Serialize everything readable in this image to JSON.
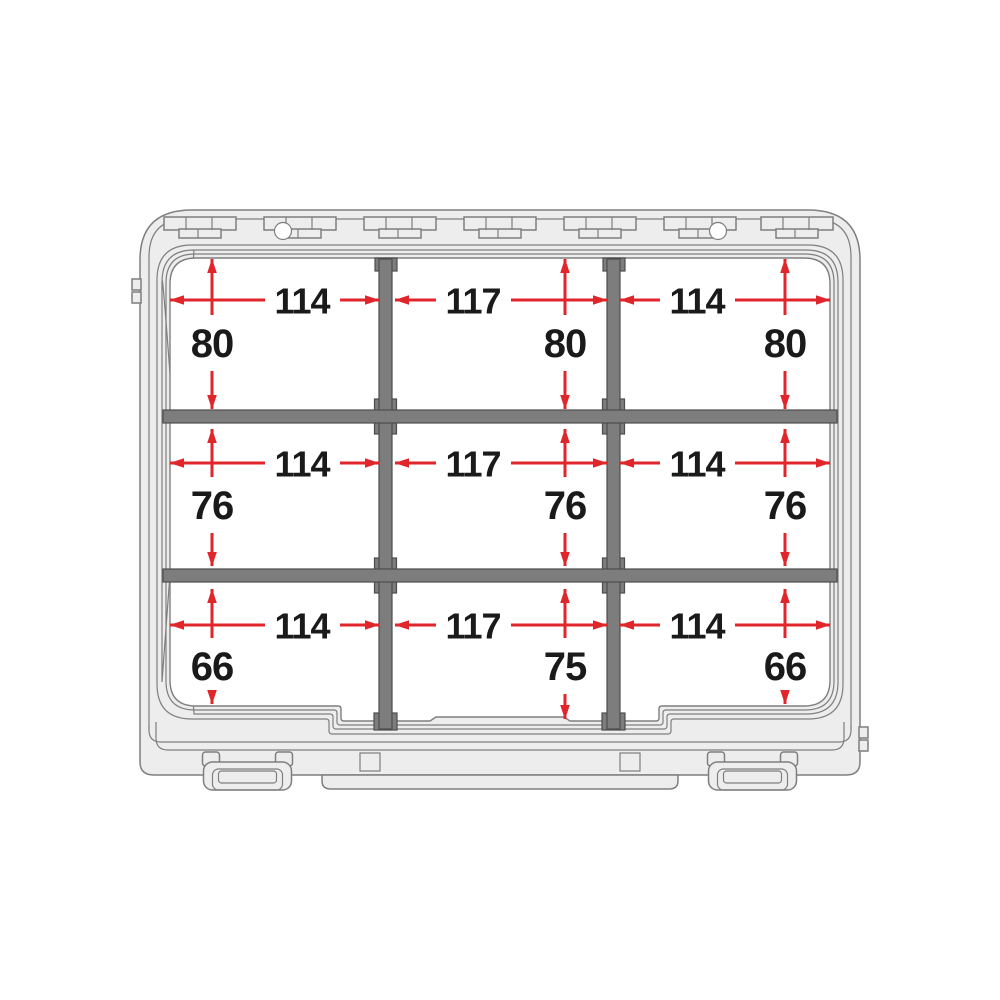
{
  "diagram": {
    "type": "technical-dimension-diagram",
    "subject": "storage case interior with two cross dividers forming a 3x3 compartment grid, dimensions in mm",
    "rows": [
      {
        "widths": [
          "114",
          "117",
          "114"
        ],
        "heights": [
          "80",
          "80",
          "80"
        ]
      },
      {
        "widths": [
          "114",
          "117",
          "114"
        ],
        "heights": [
          "76",
          "76",
          "76"
        ]
      },
      {
        "widths": [
          "114",
          "117",
          "114"
        ],
        "heights": [
          "66",
          "75",
          "66"
        ]
      }
    ],
    "colors": {
      "dimension_red": "#e0252b",
      "divider_gray": "#7d7d7d",
      "divider_stroke": "#4c4c4c",
      "case_fill": "#ededed",
      "case_stroke": "#7f7f7f",
      "label_text": "#1a1a1a",
      "background": "#ffffff"
    }
  }
}
